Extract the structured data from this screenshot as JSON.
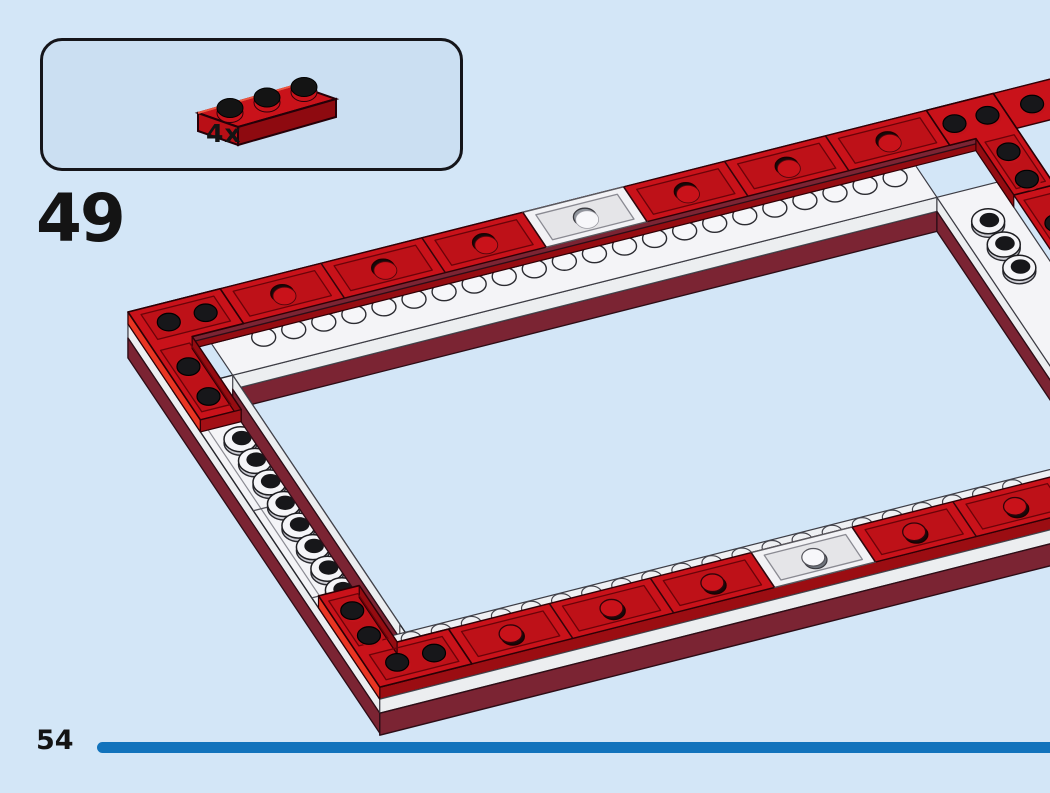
{
  "page": {
    "step_number": "49",
    "page_number": "54"
  },
  "callout": {
    "quantity": "4x",
    "part": "red-plate-1x3"
  },
  "colors": {
    "background": "#d3e6f7",
    "callout_fill": "#cbdff2",
    "outline": "#1b1b1f",
    "red_top": "#c9121a",
    "red_bright": "#e93522",
    "red_dark": "#950c11",
    "red_face": "#b90f16",
    "maroon": "#7b2433",
    "maroon_stroke": "#2c0d16",
    "white_top": "#f4f4f7",
    "white_side": "#eceef0",
    "stud_black": "#17171a",
    "bar_blue": "#1273bc",
    "text": "#141414"
  }
}
